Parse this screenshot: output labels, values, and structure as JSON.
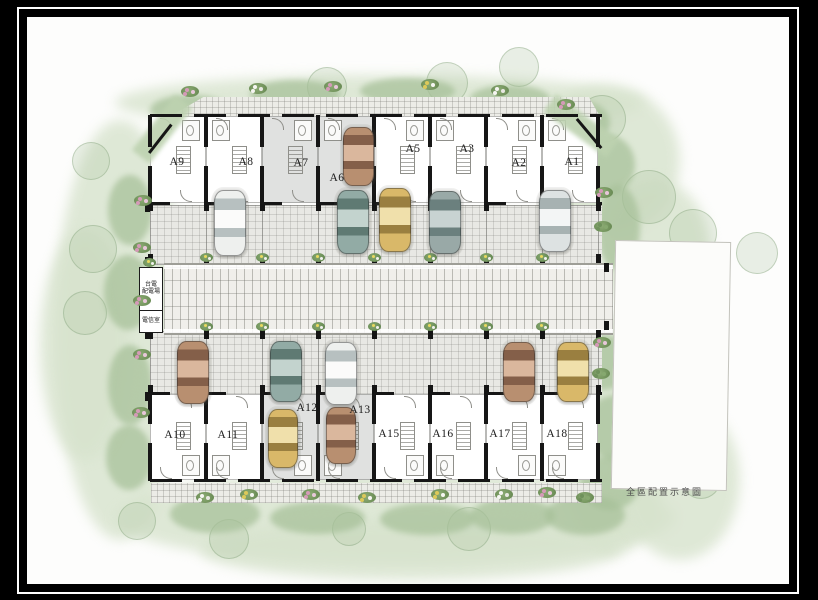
{
  "figure": {
    "caption": "全區配置示意圖",
    "frame_outer_color": "#000000",
    "paper_color": "#fdfdfc",
    "greenery_color": "#a6c098"
  },
  "site": {
    "units_top": [
      {
        "label": "A9"
      },
      {
        "label": "A8"
      },
      {
        "label": "A7"
      },
      {
        "label": "A6"
      },
      {
        "label": "A5"
      },
      {
        "label": "A3"
      },
      {
        "label": "A2"
      },
      {
        "label": "A1"
      }
    ],
    "units_bottom": [
      {
        "label": "A10"
      },
      {
        "label": "A11"
      },
      {
        "label": "A12"
      },
      {
        "label": "A13"
      },
      {
        "label": "A15"
      },
      {
        "label": "A16"
      },
      {
        "label": "A17"
      },
      {
        "label": "A18"
      }
    ],
    "shaded_units": [
      "A7",
      "A6",
      "A12",
      "A13"
    ],
    "utility_boxes": [
      {
        "name": "taipower-distribution-box",
        "label": "台電\n配電場"
      },
      {
        "name": "telecom-room-box",
        "label": "電信室"
      }
    ],
    "cars": [
      {
        "unit": "A8",
        "spot": "driveway",
        "color": "white",
        "x": 214,
        "y": 190,
        "w": 30,
        "h": 64
      },
      {
        "unit": "A6",
        "spot": "garage",
        "color": "brown",
        "x": 343,
        "y": 127,
        "w": 29,
        "h": 57
      },
      {
        "unit": "A6",
        "spot": "driveway",
        "color": "teal",
        "x": 337,
        "y": 190,
        "w": 30,
        "h": 62
      },
      {
        "unit": "A5",
        "spot": "driveway",
        "color": "gold",
        "x": 379,
        "y": 188,
        "w": 30,
        "h": 62
      },
      {
        "unit": "A3",
        "spot": "driveway",
        "color": "sage",
        "x": 429,
        "y": 191,
        "w": 30,
        "h": 61
      },
      {
        "unit": "A1",
        "spot": "driveway",
        "color": "silver",
        "x": 539,
        "y": 190,
        "w": 30,
        "h": 60
      },
      {
        "unit": "A10",
        "spot": "driveway",
        "color": "brown",
        "x": 177,
        "y": 341,
        "w": 30,
        "h": 61
      },
      {
        "unit": "A12",
        "spot": "driveway",
        "color": "teal",
        "x": 270,
        "y": 341,
        "w": 30,
        "h": 59
      },
      {
        "unit": "A13",
        "spot": "driveway",
        "color": "white",
        "x": 325,
        "y": 342,
        "w": 30,
        "h": 61
      },
      {
        "unit": "A17",
        "spot": "driveway",
        "color": "brown",
        "x": 503,
        "y": 342,
        "w": 30,
        "h": 58
      },
      {
        "unit": "A18",
        "spot": "driveway",
        "color": "gold",
        "x": 557,
        "y": 342,
        "w": 30,
        "h": 58
      },
      {
        "unit": "A12",
        "spot": "garage",
        "color": "gold",
        "x": 268,
        "y": 409,
        "w": 28,
        "h": 57
      },
      {
        "unit": "A13",
        "spot": "garage",
        "color": "brown",
        "x": 326,
        "y": 407,
        "w": 28,
        "h": 55
      }
    ],
    "car_colors": {
      "white": {
        "base": "#eef0ee",
        "glass": "#b7c0c0",
        "light": "#fbfbfa"
      },
      "silver": {
        "base": "#dde2e2",
        "glass": "#a7b2b2",
        "light": "#f3f5f5"
      },
      "teal": {
        "base": "#92aba5",
        "glass": "#5f7a73",
        "light": "#c3d3ce"
      },
      "sage": {
        "base": "#99a9a7",
        "glass": "#6b807e",
        "light": "#c8d3d2"
      },
      "gold": {
        "base": "#d9b869",
        "glass": "#9a7f40",
        "light": "#f0e0ab"
      },
      "brown": {
        "base": "#b88f70",
        "glass": "#845f49",
        "light": "#dab79d"
      }
    }
  }
}
